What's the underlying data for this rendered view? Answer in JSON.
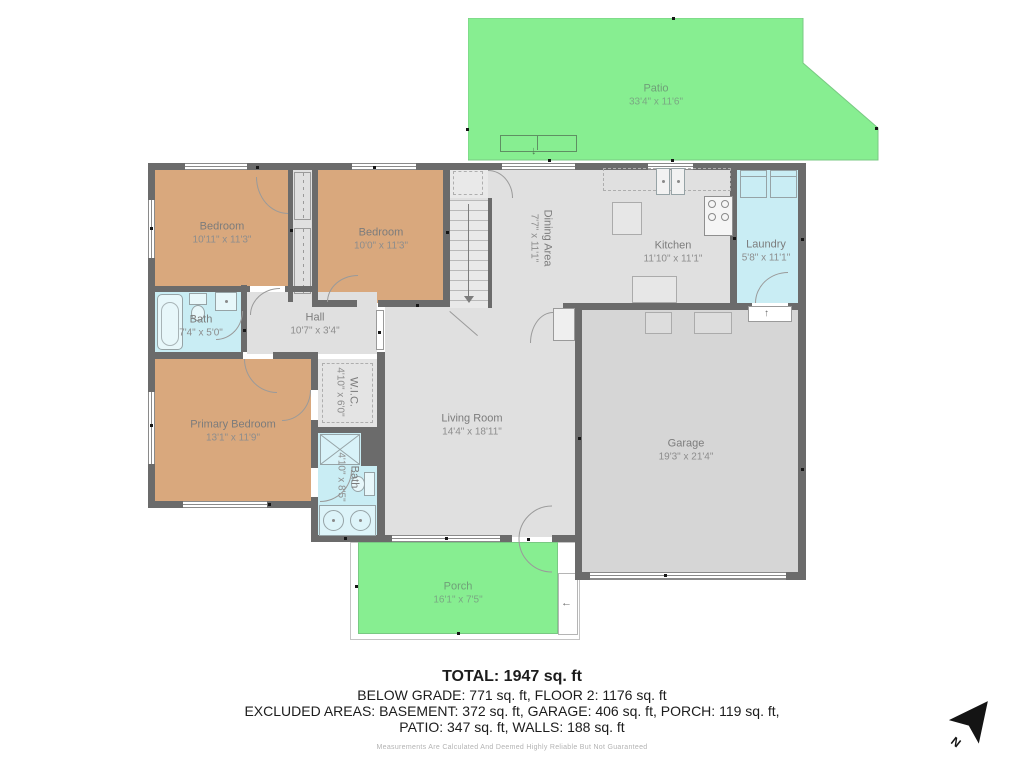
{
  "title": "Floor plan",
  "rooms": [
    {
      "name": "Patio",
      "dims": "33'4\" x 11'6\""
    },
    {
      "name": "Bedroom",
      "dims": "10'11\" x 11'3\""
    },
    {
      "name": "Bedroom",
      "dims": "10'0\" x 11'3\""
    },
    {
      "name": "Bath",
      "dims": "7'4\" x 5'0\""
    },
    {
      "name": "Hall",
      "dims": "10'7\" x 3'4\""
    },
    {
      "name": "Dining Area",
      "dims": "7'7\" x 11'1\""
    },
    {
      "name": "Kitchen",
      "dims": "11'10\" x 11'1\""
    },
    {
      "name": "Laundry",
      "dims": "5'8\" x 11'1\""
    },
    {
      "name": "Primary Bedroom",
      "dims": "13'1\" x 11'9\""
    },
    {
      "name": "W.I.C.",
      "dims": "4'10\" x 6'0\""
    },
    {
      "name": "Bath",
      "dims": "4'10\" x 8'5\""
    },
    {
      "name": "Living Room",
      "dims": "14'4\" x 18'11\""
    },
    {
      "name": "Garage",
      "dims": "19'3\" x 21'4\""
    },
    {
      "name": "Porch",
      "dims": "16'1\" x 7'5\""
    }
  ],
  "summary": {
    "total": "TOTAL: 1947 sq. ft",
    "line2": "BELOW GRADE: 771 sq. ft, FLOOR 2: 1176 sq. ft",
    "line3": "EXCLUDED AREAS: BASEMENT: 372 sq. ft, GARAGE: 406 sq. ft, PORCH: 119 sq. ft,",
    "line4": "PATIO: 347 sq. ft, WALLS: 188 sq. ft",
    "disclaimer": "Measurements Are Calculated And Deemed Highly Reliable But Not Guaranteed"
  },
  "compass": {
    "north_label": "N"
  },
  "icons": {
    "arrow_up": "↑",
    "arrow_down": "↓",
    "arrow_left": "←"
  },
  "colors": {
    "wall": "#6b6b6b",
    "bedroom_floor": "#d9a87d",
    "wet_room_floor": "#c9edf4",
    "interior_floor": "#e0e0e0",
    "garage_floor": "#d6d6d6",
    "outdoor_green": "#87ee91"
  }
}
